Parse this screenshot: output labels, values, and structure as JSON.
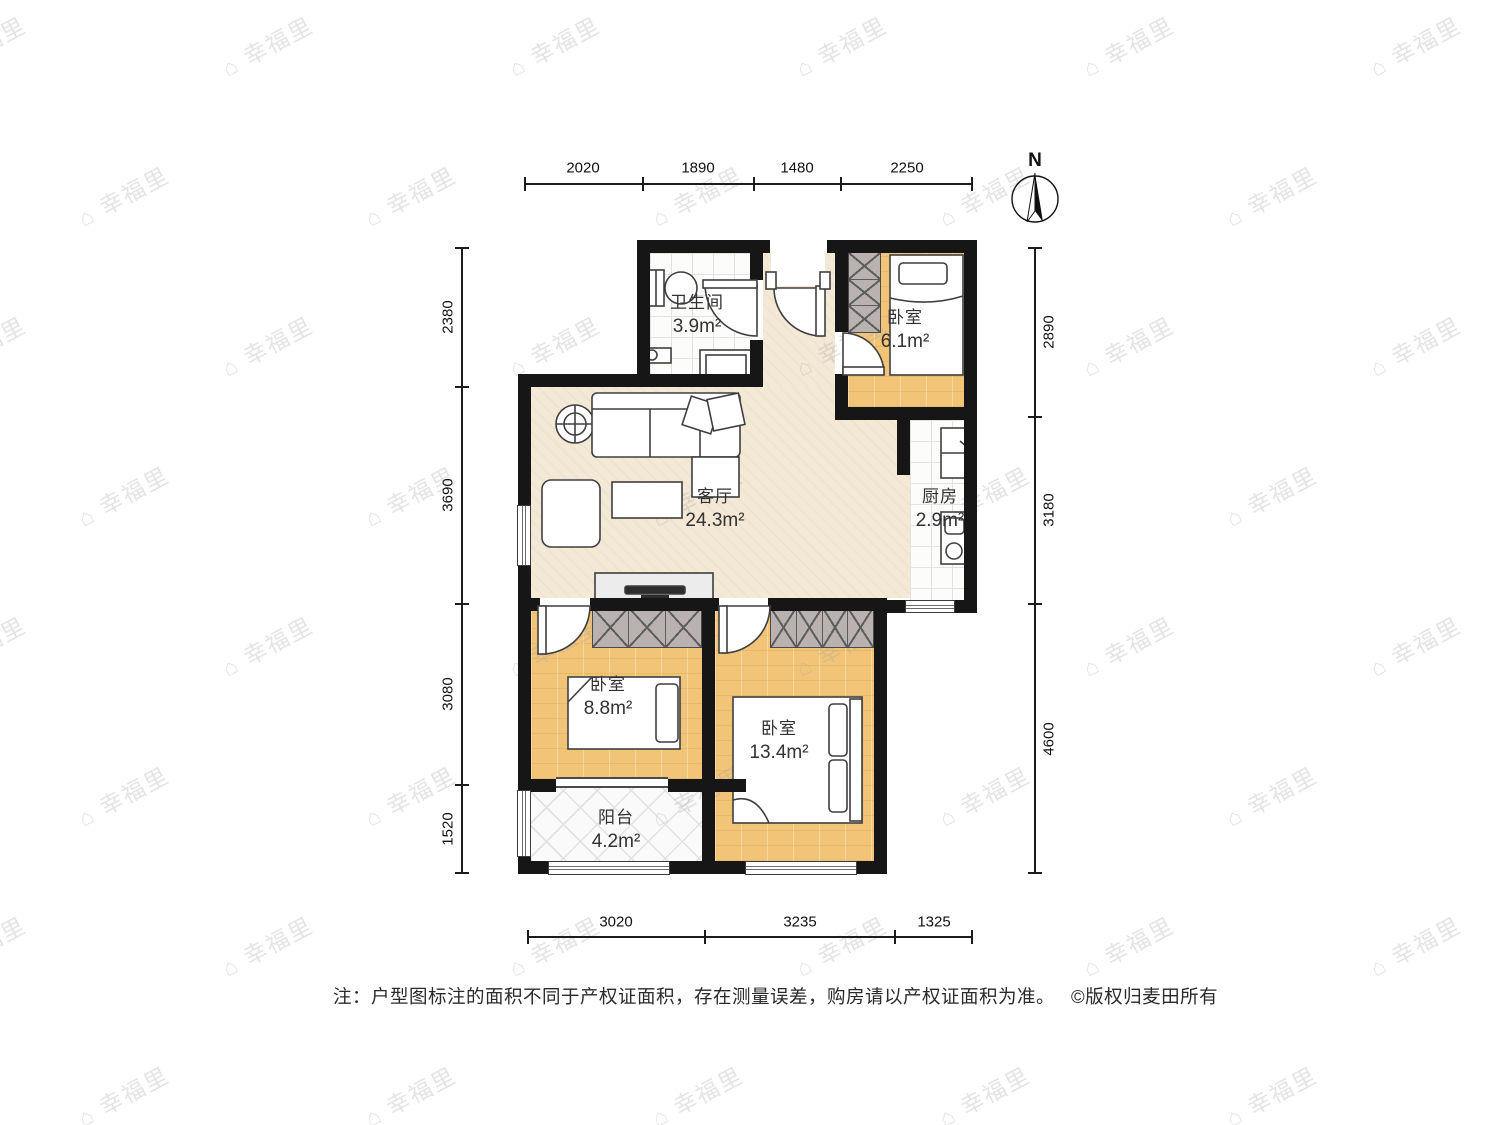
{
  "compass": {
    "label": "N"
  },
  "dimensions": {
    "top": [
      "2020",
      "1890",
      "1480",
      "2250"
    ],
    "bottom": [
      "3020",
      "3235",
      "1325"
    ],
    "left": [
      "2380",
      "3690",
      "3080",
      "1520"
    ],
    "right": [
      "2890",
      "3180",
      "4600"
    ]
  },
  "rooms": [
    {
      "name": "卫生间",
      "area": "3.9m²"
    },
    {
      "name": "卧室",
      "area": "6.1m²"
    },
    {
      "name": "客厅",
      "area": "24.3m²"
    },
    {
      "name": "厨房",
      "area": "2.9m²"
    },
    {
      "name": "卧室",
      "area": "8.8m²"
    },
    {
      "name": "卧室",
      "area": "13.4m²"
    },
    {
      "name": "阳台",
      "area": "4.2m²"
    }
  ],
  "note": {
    "text": "注：户型图标注的面积不同于产权证面积，存在测量误差，购房请以产权证面积为准。",
    "copyright": "©版权归麦田所有"
  },
  "watermark": {
    "icon": "⌂",
    "text": "幸福里"
  },
  "colors": {
    "wall": "#161616",
    "wood_floor": "#f2c478",
    "living_floor": "#f3e9d6",
    "wardrobe": "#b9b2b1",
    "text": "#323232"
  }
}
